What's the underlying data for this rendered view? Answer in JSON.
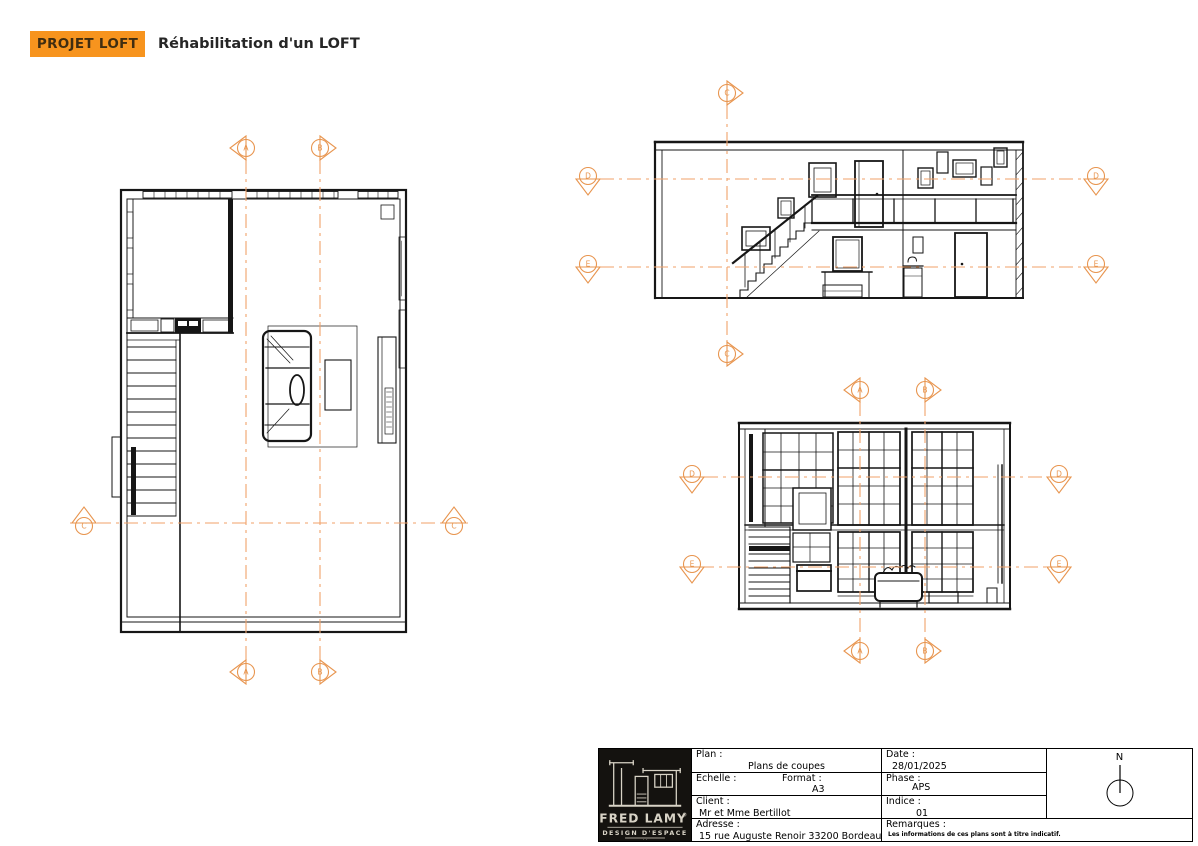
{
  "sheet": {
    "background": "#ffffff"
  },
  "header": {
    "badge": "PROJET LOFT",
    "title": "Réhabilitation d'un LOFT"
  },
  "colors": {
    "accent": "#f7941e",
    "marker": "#e8954f",
    "cut_line": "#f0a26a",
    "ink": "#161616"
  },
  "drawing": {
    "cut_lines": [
      {
        "x1": 246,
        "y1": 160,
        "x2": 246,
        "y2": 660
      },
      {
        "x1": 320,
        "y1": 160,
        "x2": 320,
        "y2": 660
      },
      {
        "x1": 70,
        "y1": 523,
        "x2": 468,
        "y2": 523
      },
      {
        "x1": 727,
        "y1": 105,
        "x2": 727,
        "y2": 342
      },
      {
        "x1": 600,
        "y1": 179,
        "x2": 1084,
        "y2": 179
      },
      {
        "x1": 600,
        "y1": 267,
        "x2": 1084,
        "y2": 267
      },
      {
        "x1": 860,
        "y1": 402,
        "x2": 860,
        "y2": 639
      },
      {
        "x1": 925,
        "y1": 402,
        "x2": 925,
        "y2": 640
      },
      {
        "x1": 704,
        "y1": 477,
        "x2": 1047,
        "y2": 477
      },
      {
        "x1": 700,
        "y1": 567,
        "x2": 1047,
        "y2": 567
      }
    ],
    "markers": [
      {
        "letter": "A",
        "x": 246,
        "y": 148,
        "dir": "left"
      },
      {
        "letter": "B",
        "x": 320,
        "y": 148,
        "dir": "right"
      },
      {
        "letter": "A",
        "x": 246,
        "y": 672,
        "dir": "left"
      },
      {
        "letter": "B",
        "x": 320,
        "y": 672,
        "dir": "right"
      },
      {
        "letter": "C",
        "x": 84,
        "y": 523,
        "dir": "up"
      },
      {
        "letter": "C",
        "x": 454,
        "y": 523,
        "dir": "up"
      },
      {
        "letter": "C",
        "x": 727,
        "y": 93,
        "dir": "right"
      },
      {
        "letter": "C",
        "x": 727,
        "y": 354,
        "dir": "right"
      },
      {
        "letter": "D",
        "x": 588,
        "y": 179,
        "dir": "down"
      },
      {
        "letter": "E",
        "x": 588,
        "y": 267,
        "dir": "down"
      },
      {
        "letter": "D",
        "x": 1096,
        "y": 179,
        "dir": "down"
      },
      {
        "letter": "E",
        "x": 1096,
        "y": 267,
        "dir": "down"
      },
      {
        "letter": "A",
        "x": 860,
        "y": 390,
        "dir": "left"
      },
      {
        "letter": "B",
        "x": 925,
        "y": 390,
        "dir": "right"
      },
      {
        "letter": "A",
        "x": 860,
        "y": 651,
        "dir": "left"
      },
      {
        "letter": "B",
        "x": 925,
        "y": 651,
        "dir": "right"
      },
      {
        "letter": "D",
        "x": 692,
        "y": 477,
        "dir": "down"
      },
      {
        "letter": "D",
        "x": 1059,
        "y": 477,
        "dir": "down"
      },
      {
        "letter": "E",
        "x": 692,
        "y": 567,
        "dir": "down"
      },
      {
        "letter": "E",
        "x": 1059,
        "y": 567,
        "dir": "down"
      }
    ]
  },
  "title_block": {
    "plan_label": "Plan :",
    "plan_value": "Plans de coupes",
    "echelle_label": "Echelle :",
    "echelle_value": "",
    "format_label": "Format :",
    "format_value": "A3",
    "client_label": "Client :",
    "client_value": "Mr et Mme Bertillot",
    "adresse_label": "Adresse :",
    "adresse_value": "15 rue Auguste Renoir 33200 Bordeaux",
    "date_label": "Date :",
    "date_value": "28/01/2025",
    "phase_label": "Phase :",
    "phase_value": "APS",
    "indice_label": "Indice :",
    "indice_value": "01",
    "remarques_label": "Remarques :",
    "remarques_value": "Les informations de ces plans sont à titre indicatif.",
    "north_label": "N",
    "logo": {
      "brand": "FRED LAMY",
      "registered": "®",
      "tagline": "DESIGN D'ESPACE",
      "dots": "· ·"
    }
  }
}
